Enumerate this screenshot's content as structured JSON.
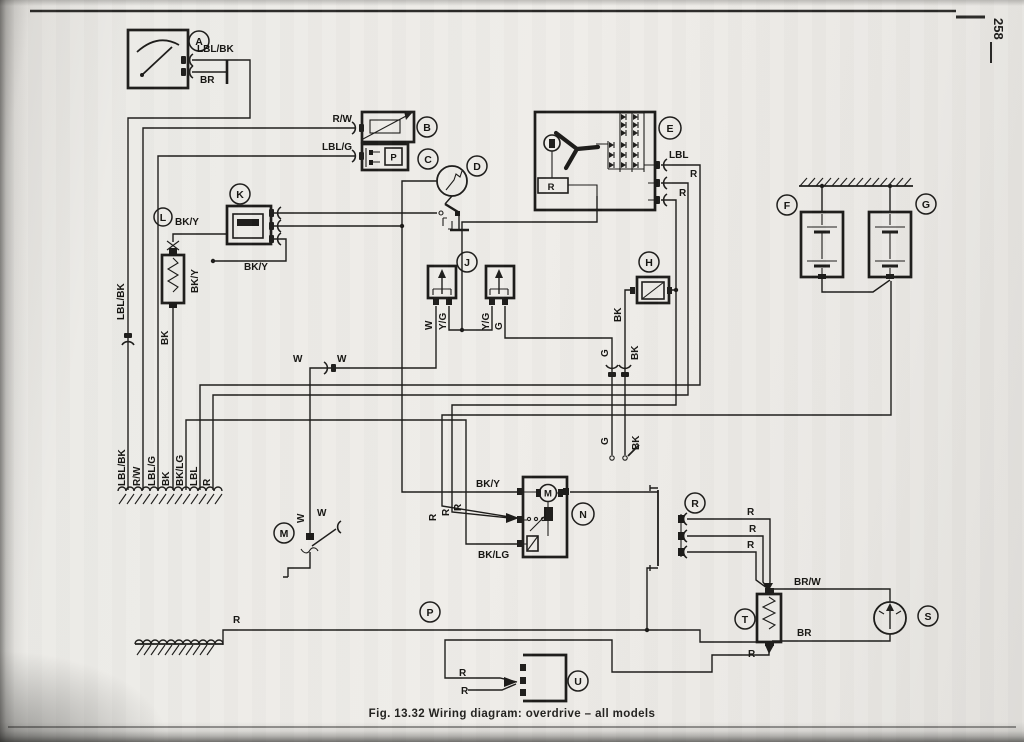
{
  "page": {
    "number": "258",
    "caption": "Fig. 13.32 Wiring diagram: overdrive – all models"
  },
  "components": {
    "a": "A",
    "b": "B",
    "c": "C",
    "d": "D",
    "e": "E",
    "f": "F",
    "g": "G",
    "h": "H",
    "j": "J",
    "k": "K",
    "l": "L",
    "m": "M",
    "n": "N",
    "p": "P",
    "r": "R",
    "s": "S",
    "t": "T",
    "u": "U"
  },
  "inner_labels": {
    "regulator": "R",
    "pilot_lamp": "P",
    "motor": "M"
  },
  "wire_labels": {
    "lbl_bk": "LBL/BK",
    "br": "BR",
    "r_w": "R/W",
    "lbl_g": "LBL/G",
    "lbl": "LBL",
    "r": "R",
    "bk_y": "BK/Y",
    "bk": "BK",
    "w": "W",
    "y_g": "Y/G",
    "g": "G",
    "bk_lg": "BK/LG",
    "br_w": "BR/W"
  }
}
